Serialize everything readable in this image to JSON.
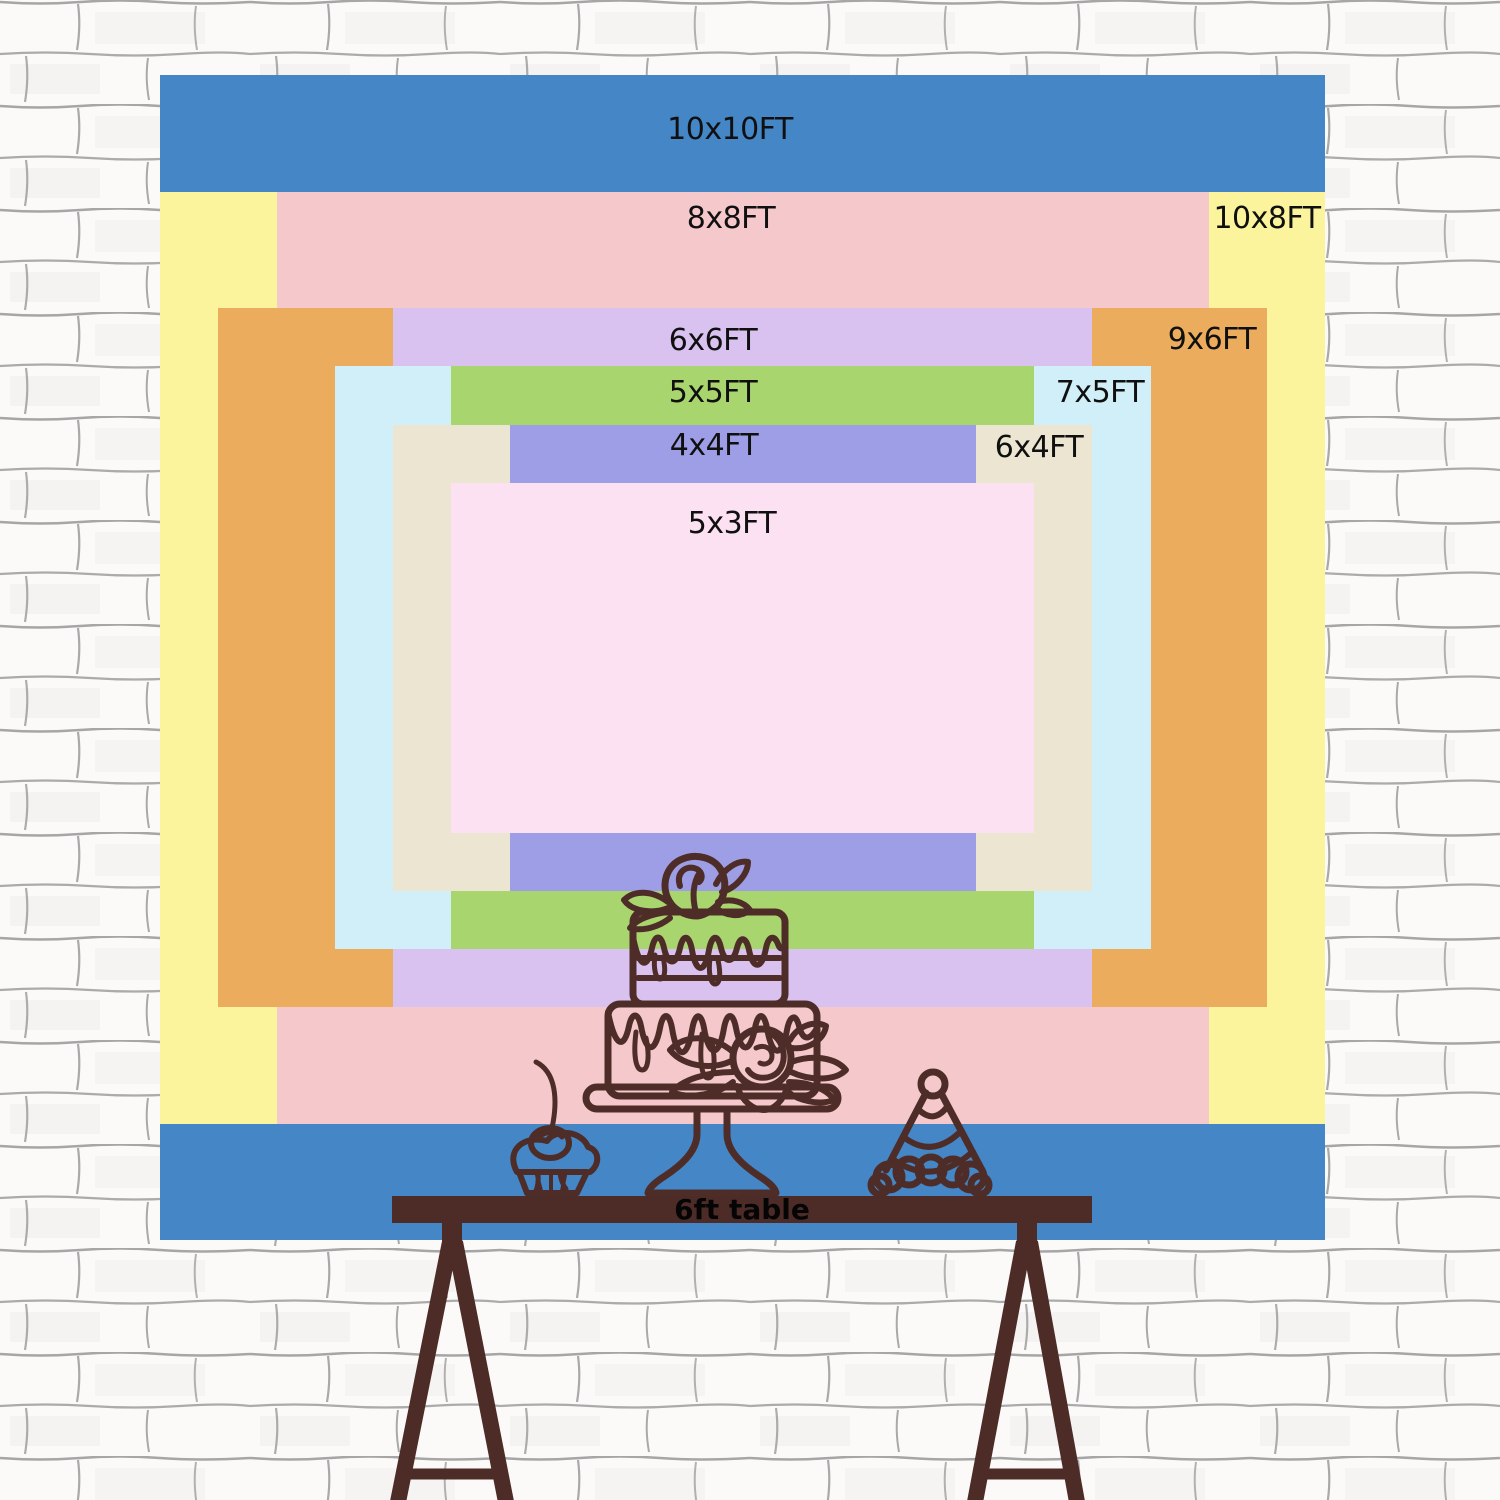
{
  "backdrop": {
    "description": "nested backdrop size chart",
    "unit": "FT",
    "sizes": [
      {
        "label": "10x10FT",
        "width_ft": 10,
        "height_ft": 10,
        "color": "#4486c6",
        "color_name": "blue"
      },
      {
        "label": "10x8FT",
        "width_ft": 10,
        "height_ft": 8,
        "color": "#fbf49c",
        "color_name": "yellow"
      },
      {
        "label": "8x8FT",
        "width_ft": 8,
        "height_ft": 8,
        "color": "#f5c9cc",
        "color_name": "pink"
      },
      {
        "label": "9x6FT",
        "width_ft": 9,
        "height_ft": 6,
        "color": "#ebac5d",
        "color_name": "orange"
      },
      {
        "label": "6x6FT",
        "width_ft": 6,
        "height_ft": 6,
        "color": "#d9c2ef",
        "color_name": "lavender"
      },
      {
        "label": "7x5FT",
        "width_ft": 7,
        "height_ft": 5,
        "color": "#d1eff9",
        "color_name": "light-blue"
      },
      {
        "label": "5x5FT",
        "width_ft": 5,
        "height_ft": 5,
        "color": "#a9d56e",
        "color_name": "green"
      },
      {
        "label": "6x4FT",
        "width_ft": 6,
        "height_ft": 4,
        "color": "#ece5d2",
        "color_name": "beige"
      },
      {
        "label": "4x4FT",
        "width_ft": 4,
        "height_ft": 4,
        "color": "#9e9ee7",
        "color_name": "periwinkle"
      },
      {
        "label": "5x3FT",
        "width_ft": 5,
        "height_ft": 3,
        "color": "#fce1f2",
        "color_name": "light-pink"
      }
    ]
  },
  "table": {
    "label": "6ft table",
    "color": "#4d2c27"
  },
  "decorations": {
    "line_color": "#4e2d29",
    "items": [
      "two-tier cake on stand",
      "cherry cupcake",
      "party hat"
    ]
  },
  "wall": {
    "style": "white painted brick"
  }
}
